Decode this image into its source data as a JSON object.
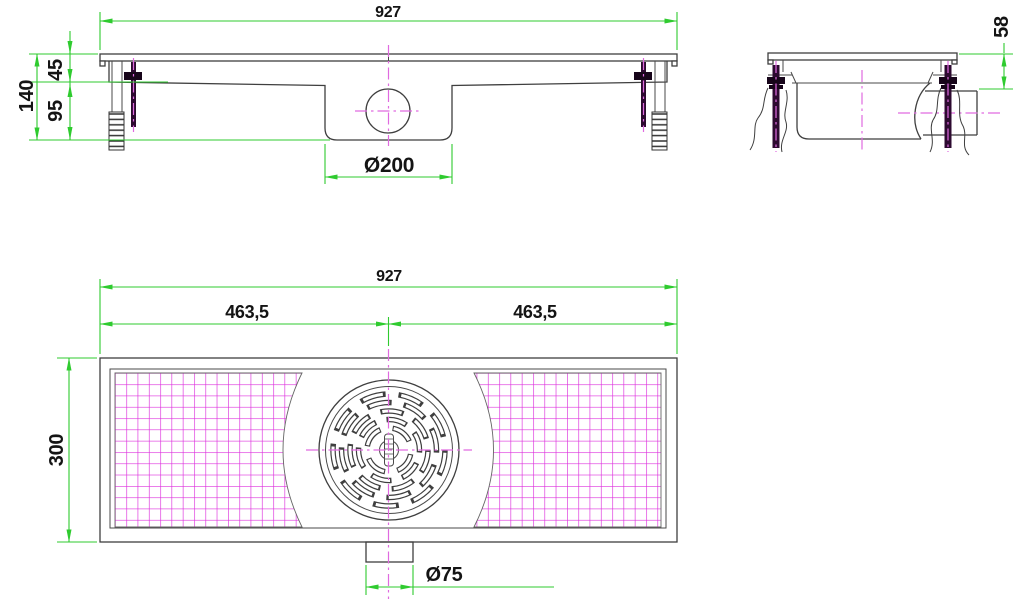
{
  "drawing": {
    "type": "technical-drawing-floor-drain",
    "front_view": {
      "width": "927",
      "total_height": "140",
      "top_height": "45",
      "body_height": "95",
      "sump_diameter": "Ø200"
    },
    "end_view": {
      "flange_to_outlet_height": "58"
    },
    "plan_view": {
      "width": "927",
      "half_left": "463,5",
      "half_right": "463,5",
      "depth": "300",
      "outlet_diameter": "Ø75"
    },
    "colors": {
      "dimension_green": "#2fcb2f",
      "mesh_magenta": "#dd2fdd",
      "centerline_magenta": "#e06ae0",
      "bolt_purple": "#2d0a30",
      "outline_gray": "#3f3f3f"
    }
  }
}
